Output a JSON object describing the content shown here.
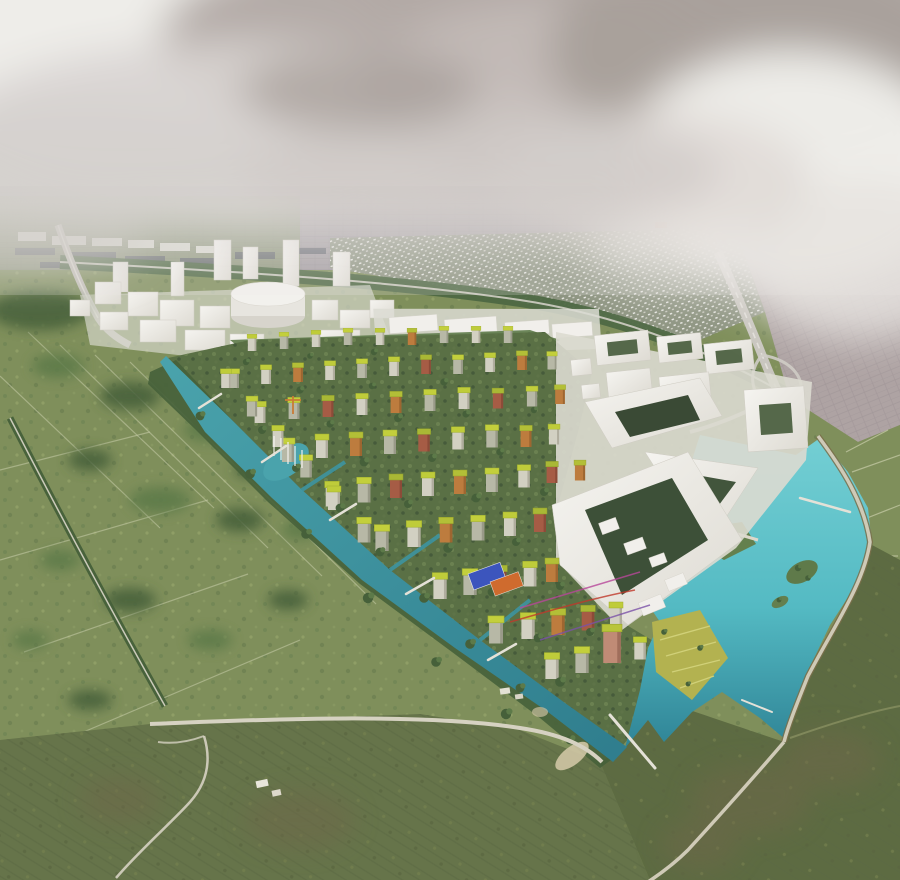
{
  "scene": {
    "type": "architectural-aerial-rendering",
    "view": "bird's-eye masterplan visualization, overcast sky",
    "regions": [
      {
        "id": "sky",
        "label": "overcast sky with large cloud masses"
      },
      {
        "id": "distant-city",
        "label": "hazy distant city grid at horizon"
      },
      {
        "id": "industrial-band",
        "label": "dark industrial slabs upper left"
      },
      {
        "id": "suburb-dotted",
        "label": "low-rise suburb of small white houses"
      },
      {
        "id": "suburb-pink",
        "label": "pinkish suburban street grid upper right"
      },
      {
        "id": "rail-corridor",
        "label": "tree-lined rail corridor"
      },
      {
        "id": "highway-right",
        "label": "highway with interchange loops"
      },
      {
        "id": "highway-left",
        "label": "elevated road on the left"
      },
      {
        "id": "white-model-city",
        "label": "white massing-model towers and blocks"
      },
      {
        "id": "cylinder-building",
        "label": "large white cylindrical building"
      },
      {
        "id": "courtyard-complex",
        "label": "large angular white courtyard complex"
      },
      {
        "id": "eco-district",
        "label": "colorful mid-rise district with green roofs"
      },
      {
        "id": "canal",
        "label": "teal canal along the district edge with fountains"
      },
      {
        "id": "lake",
        "label": "turquoise lake with islands and dike"
      },
      {
        "id": "terraces",
        "label": "yellow garden terraces at the waterfront"
      },
      {
        "id": "sports-courts",
        "label": "blue and orange sports courts"
      },
      {
        "id": "fields-left",
        "label": "green parcelled fields with hedgerows"
      },
      {
        "id": "meadow-bottom",
        "label": "large rough meadows with footpaths"
      }
    ]
  },
  "palette": {
    "skyTop": "#c8c4c1",
    "skyBottom": "#e3e1de",
    "cloudBright": "#efeeea",
    "cloudShadow": "#a89f9a",
    "distantCity": "#a39da1",
    "industrial": "#5d626a",
    "horizonGreen": "#7f9161",
    "suburbBase": "#8e9582",
    "suburbDot": "#f0efec",
    "suburbPink": "#aea3a3",
    "road": "#c9c6bf",
    "railTrees": "#4e6843",
    "white": "#f1efeb",
    "whiteShade": "#d9d6cf",
    "fieldBase": "#7f8f5b",
    "fieldLine": "#c3c9a4",
    "treeDark": "#46603a",
    "treeMid": "#5d7a49",
    "meadow": "#66744a",
    "meadowBrown": "#6e684a",
    "canal": "#3d93a0",
    "lake": "#5cc4cb",
    "lakeDeep": "#2f8496",
    "roofGreen": "#bfcc3a",
    "facade": "#d2d0c2",
    "facadeGray": "#b7b8a6",
    "orange": "#bd7c3e",
    "terracotta": "#a65c45",
    "pinkBldg": "#c08b76",
    "courtBlue": "#3c55bd",
    "courtOrange": "#cf6b2e",
    "path": "#d6d2c2",
    "dike": "#cfcab7",
    "sand": "#cfc5a4",
    "courtyardGreen": "#55684a",
    "terraceYellow": "#b3b250"
  }
}
